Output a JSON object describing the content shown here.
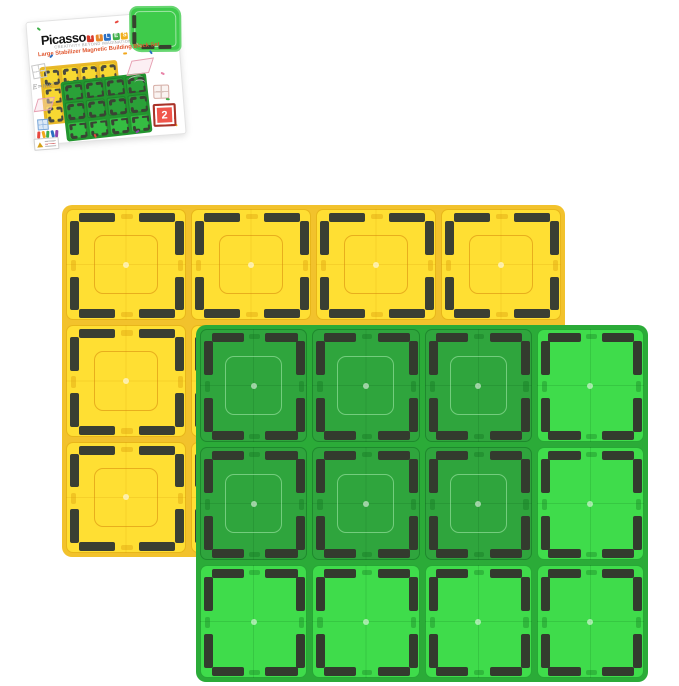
{
  "box": {
    "brand": "Picasso",
    "brand_tiles": [
      {
        "letter": "T",
        "color": "#d93a2b"
      },
      {
        "letter": "I",
        "color": "#e8892b"
      },
      {
        "letter": "L",
        "color": "#2b6fc2"
      },
      {
        "letter": "E",
        "color": "#3fae49"
      },
      {
        "letter": "S",
        "color": "#f2b01e"
      }
    ],
    "tagline": "CREATIVITY BEYOND IMAGINATION",
    "subtitle": "Large Stabilizer Magnetic Building Block Set",
    "piece_count": "2",
    "formula_doodle": "E=mc²",
    "crayon_colors": [
      "#e8483f",
      "#f2a71b",
      "#3fae49",
      "#2b6fc2",
      "#8e44ad"
    ],
    "confetti": [
      {
        "x": 10,
        "y": 6,
        "c": "#3fae49",
        "r": 40
      },
      {
        "x": 88,
        "y": 5,
        "c": "#e8483f",
        "r": -20
      },
      {
        "x": 120,
        "y": 38,
        "c": "#2b6fc2",
        "r": 60
      },
      {
        "x": 94,
        "y": 37,
        "c": "#f2a71b",
        "r": 0
      },
      {
        "x": 130,
        "y": 60,
        "c": "#e884a8",
        "r": 30
      },
      {
        "x": 20,
        "y": 34,
        "c": "#2b6fc2",
        "r": -40
      },
      {
        "x": 133,
        "y": 86,
        "c": "#3fae49",
        "r": 10
      },
      {
        "x": 58,
        "y": 117,
        "c": "#e8483f",
        "r": 70
      },
      {
        "x": 100,
        "y": 116,
        "c": "#8e44ad",
        "r": -30
      },
      {
        "x": 139,
        "y": 112,
        "c": "#f2a71b",
        "r": 45
      }
    ]
  },
  "colors": {
    "background": "#ffffff",
    "yellow_tile": "#ffdf33",
    "green_tile_bright": "#3fdc4b",
    "green_tile_overlap": "#2fa53d",
    "magnet_bar": "#3a3f33",
    "badge_red": "#f0564c"
  },
  "boards": {
    "yellow-board": {
      "left": 62,
      "top": 205,
      "width": 503,
      "height": 352,
      "rows": 3,
      "cols": 4,
      "pad": 4,
      "gap": 5,
      "radius": 10,
      "cellRadius": 7,
      "z": 1,
      "bg": "#f2c22c",
      "palette": {
        "base": "#ffdf33"
      },
      "cellBorder": "rgba(214,148,6,0.55)",
      "seam": "rgba(208,140,0,0.18)",
      "barColor": "#3a3f33",
      "barT": 9,
      "barInset": 3,
      "barLenPct": 0.3,
      "barPos": [
        0.1,
        0.6
      ],
      "inner": {
        "pct": 23,
        "color": "rgba(210,126,8,0.5)",
        "radius": 9,
        "w": 1.5
      },
      "dot": {
        "size": 6,
        "color": "rgba(255,255,255,0.6)"
      },
      "nubColor": "rgba(214,148,6,0.35)"
    },
    "green-board": {
      "left": 196,
      "top": 325,
      "width": 452,
      "height": 357,
      "rows": 3,
      "cols": 4,
      "pad": 4,
      "gap": 5,
      "radius": 10,
      "cellRadius": 7,
      "z": 2,
      "bg": "#2bab38",
      "palette": {
        "dark": "#2fa53d",
        "bright": "#3fdc4b"
      },
      "shades": [
        [
          "dark",
          "dark",
          "dark",
          "bright"
        ],
        [
          "dark",
          "dark",
          "dark",
          "bright"
        ],
        [
          "bright",
          "bright",
          "bright",
          "bright"
        ]
      ],
      "cellBorder": "rgba(12,104,26,0.45)",
      "seam": "rgba(6,90,20,0.16)",
      "barColor": "#333b2e",
      "barT": 9,
      "barInset": 3,
      "barLenPct": 0.3,
      "barPos": [
        0.1,
        0.6
      ],
      "inner": {
        "pct": 23,
        "color": "rgba(200,255,205,0.45)",
        "radius": 9,
        "w": 1.5
      },
      "innerShades": [
        "dark"
      ],
      "dot": {
        "size": 6,
        "color": "rgba(255,255,255,0.55)"
      },
      "nubColor": "rgba(12,104,26,0.3)"
    },
    "mini-yellow": {
      "left": 10,
      "top": 4,
      "width": 78,
      "height": 58,
      "rows": 3,
      "cols": 4,
      "pad": 2,
      "gap": 2,
      "radius": 3,
      "cellRadius": 2,
      "z": 1,
      "bg": "#e9b82a",
      "palette": {
        "base": "#f7d832"
      },
      "cellBorder": "rgba(200,140,0,0.4)",
      "barColor": "#4a4a40",
      "barT": 2.5,
      "barInset": 1,
      "barLenPct": 0.3,
      "barPos": [
        0.1,
        0.6
      ]
    },
    "mini-green": {
      "left": 30,
      "top": 20,
      "width": 86,
      "height": 60,
      "rows": 3,
      "cols": 4,
      "pad": 2,
      "gap": 2,
      "radius": 3,
      "cellRadius": 2,
      "z": 2,
      "rotate": -1,
      "bg": "#23952f",
      "palette": {
        "dark": "#2aa138",
        "bright": "#35bd42"
      },
      "shades": [
        [
          "dark",
          "dark",
          "dark",
          "dark"
        ],
        [
          "dark",
          "dark",
          "dark",
          "dark"
        ],
        [
          "bright",
          "bright",
          "bright",
          "bright"
        ]
      ],
      "cellBorder": "rgba(10,90,20,0.4)",
      "barColor": "#3a4434",
      "barT": 2.5,
      "barInset": 1,
      "barLenPct": 0.3,
      "barPos": [
        0.1,
        0.6
      ]
    }
  }
}
